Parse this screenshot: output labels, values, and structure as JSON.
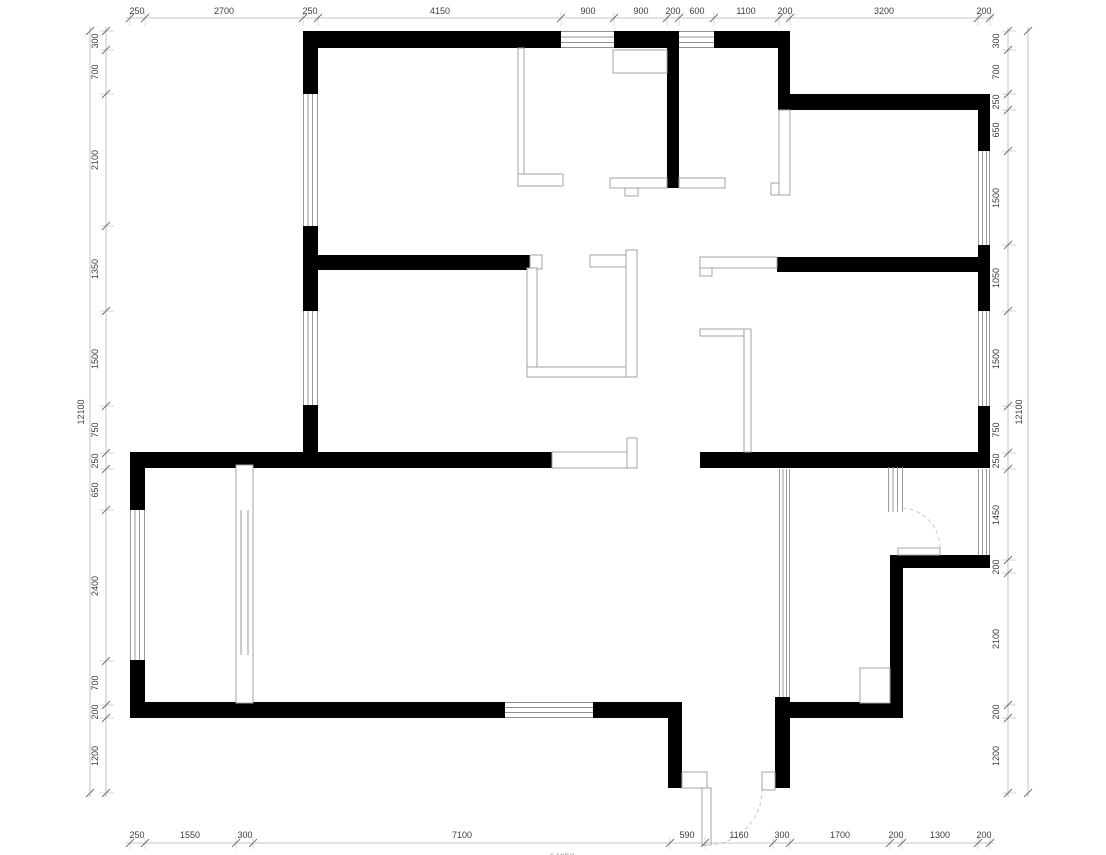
{
  "dims": {
    "top": [
      "250",
      "2700",
      "250",
      "4150",
      "900",
      "900",
      "200",
      "600",
      "1100",
      "200",
      "3200",
      "200"
    ],
    "bottom": [
      "250",
      "1550",
      "300",
      "7100",
      "590",
      "1160",
      "300",
      "1700",
      "200",
      "1300",
      "200"
    ],
    "left": [
      "300",
      "700",
      "2100",
      "1350",
      "1500",
      "750",
      "250",
      "650",
      "2400",
      "700",
      "200",
      "1200"
    ],
    "right": [
      "300",
      "700",
      "250",
      "650",
      "1500",
      "1050",
      "1500",
      "750",
      "250",
      "1450",
      "200",
      "2100",
      "200",
      "1200"
    ],
    "totals": {
      "left": "12100",
      "right": "12100",
      "bottom": "14650"
    }
  },
  "colors": {
    "wall": "#000000",
    "partition": "#a3a3a3",
    "window": "#8f8f8f",
    "dimension_line": "#b3b3b3",
    "dimension_text": "#3c3c3c",
    "door_arc": "#c6c6c6",
    "background": "#ffffff"
  }
}
